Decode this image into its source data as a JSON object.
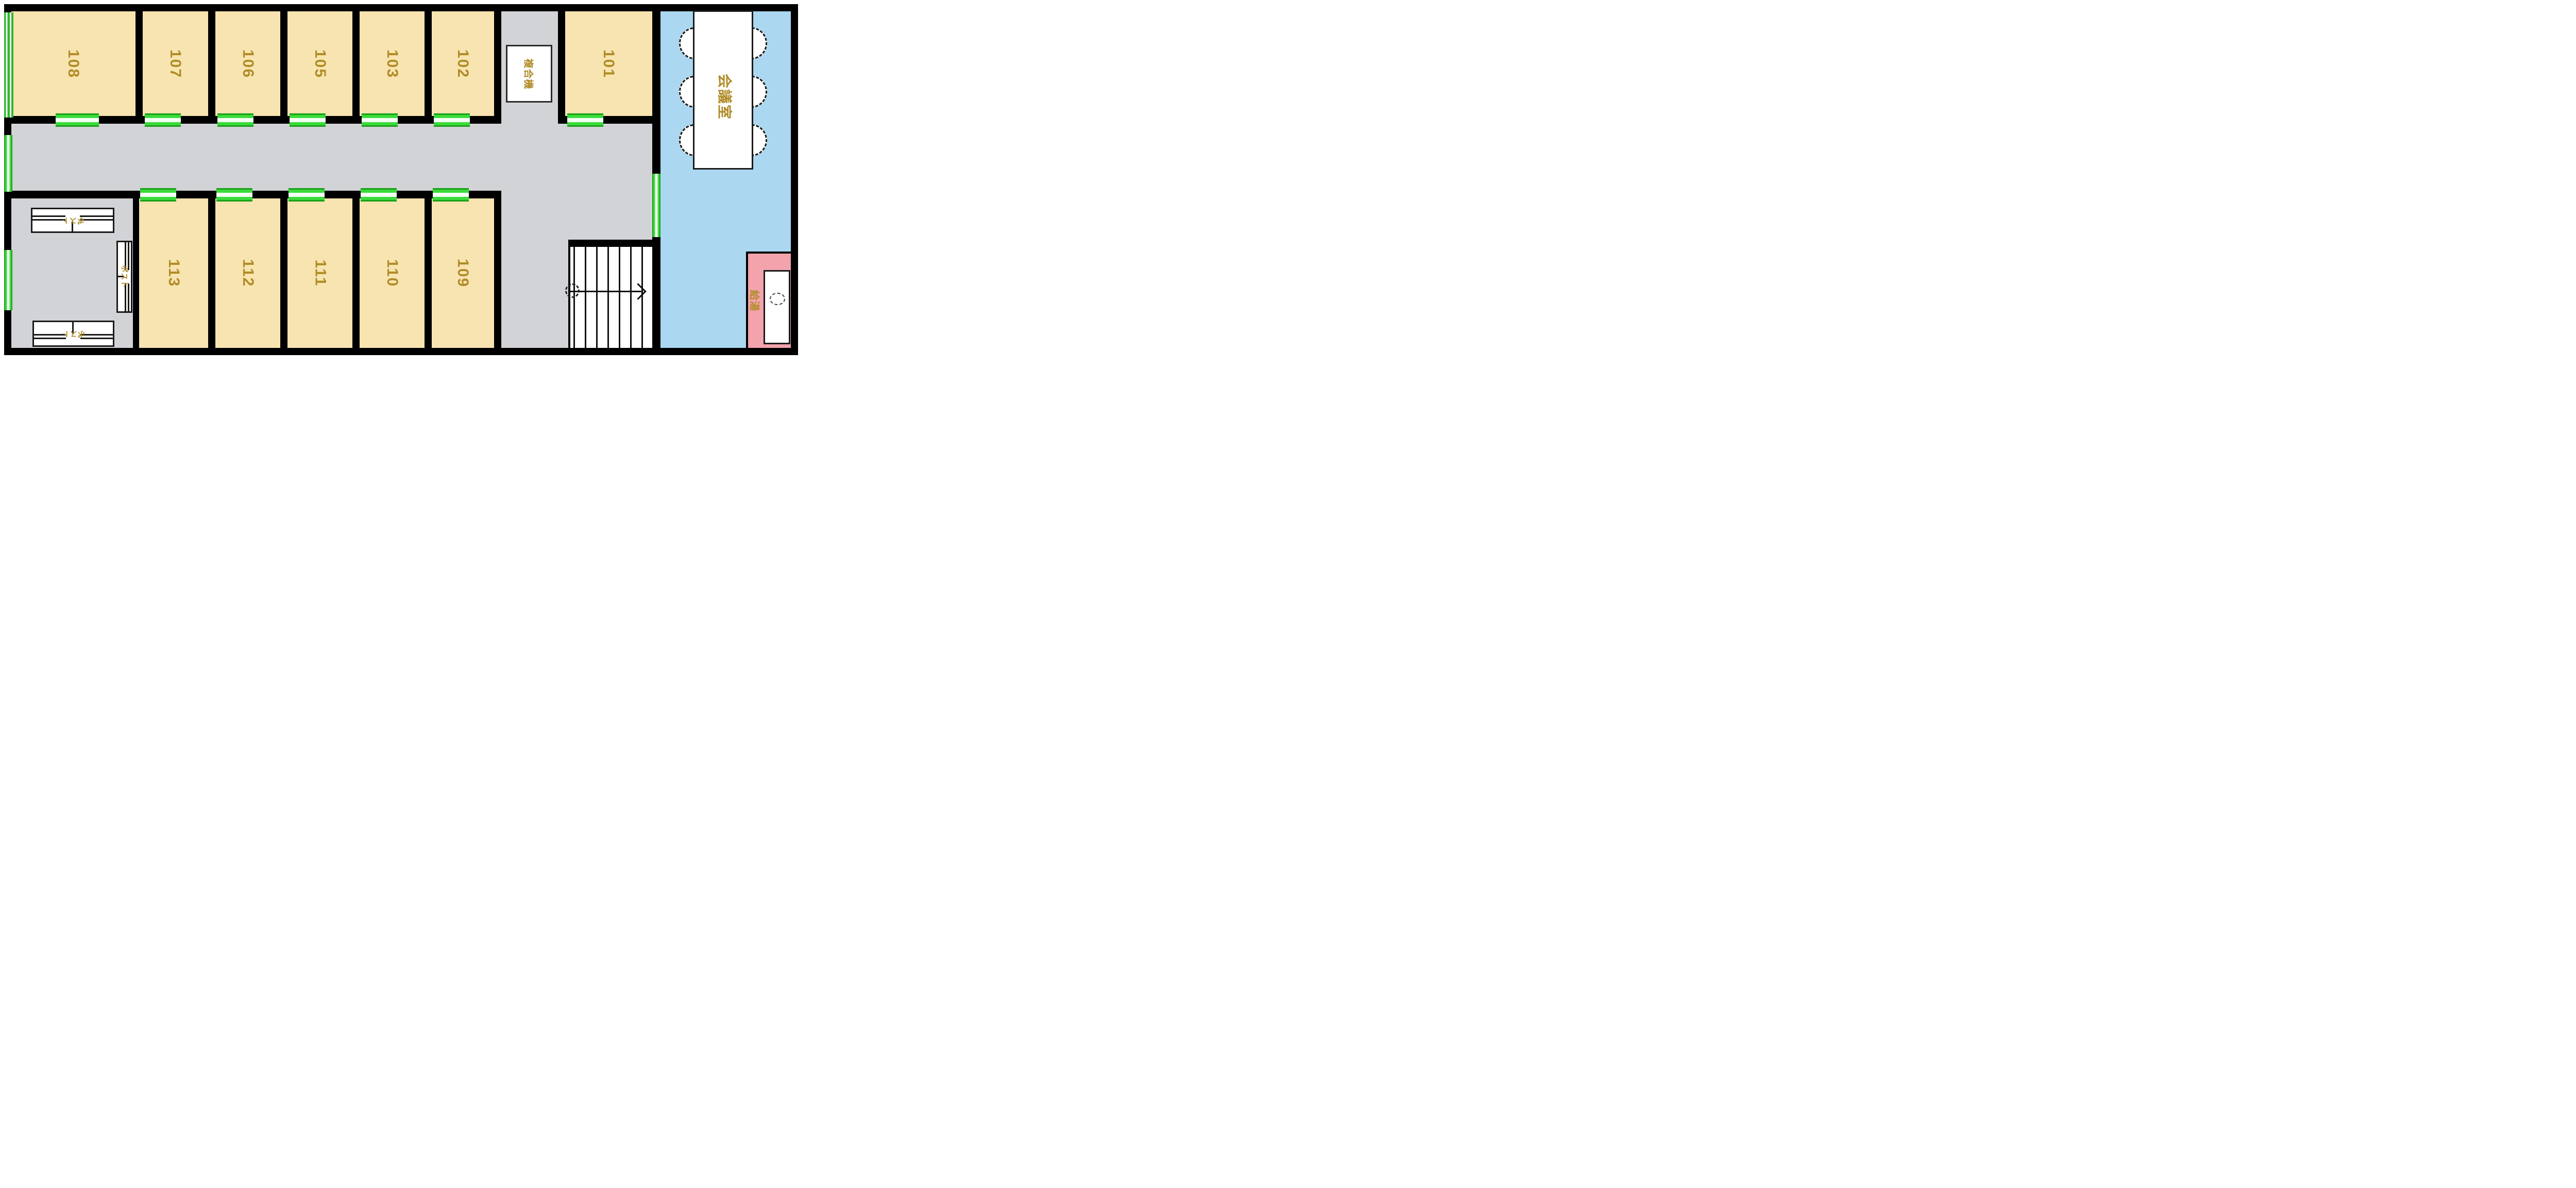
{
  "floor_plan": {
    "rooms_top": [
      {
        "number": "108"
      },
      {
        "number": "107"
      },
      {
        "number": "106"
      },
      {
        "number": "105"
      },
      {
        "number": "103"
      },
      {
        "number": "102"
      },
      {
        "number": "101"
      }
    ],
    "rooms_bottom": [
      {
        "number": "113"
      },
      {
        "number": "112"
      },
      {
        "number": "111"
      },
      {
        "number": "110"
      },
      {
        "number": "109"
      }
    ],
    "meeting_room_label": "会議室",
    "copier_label": "複合機",
    "hot_water_label": "給湯",
    "mailbox_label": "ポスト",
    "meeting_room_chair_count": 6,
    "colors": {
      "wall": "#000000",
      "room_fill": "#F8E4B0",
      "corridor_fill": "#D2D3D6",
      "meeting_room_fill": "#ABD7F0",
      "hot_water_fill": "#F2A3AC",
      "door_window_green": "#3BDB3B",
      "label_gold": "#B08C28",
      "furniture_fill": "#FFFFFF"
    },
    "icons": {
      "stairs": "staircase-with-direction-arrow",
      "chair": "oval-chair",
      "sink": "counter-with-basin-oval",
      "mailbox": "mail-slot-box",
      "door_marker": "green-door-segment",
      "window_marker": "green-window-segment"
    }
  }
}
